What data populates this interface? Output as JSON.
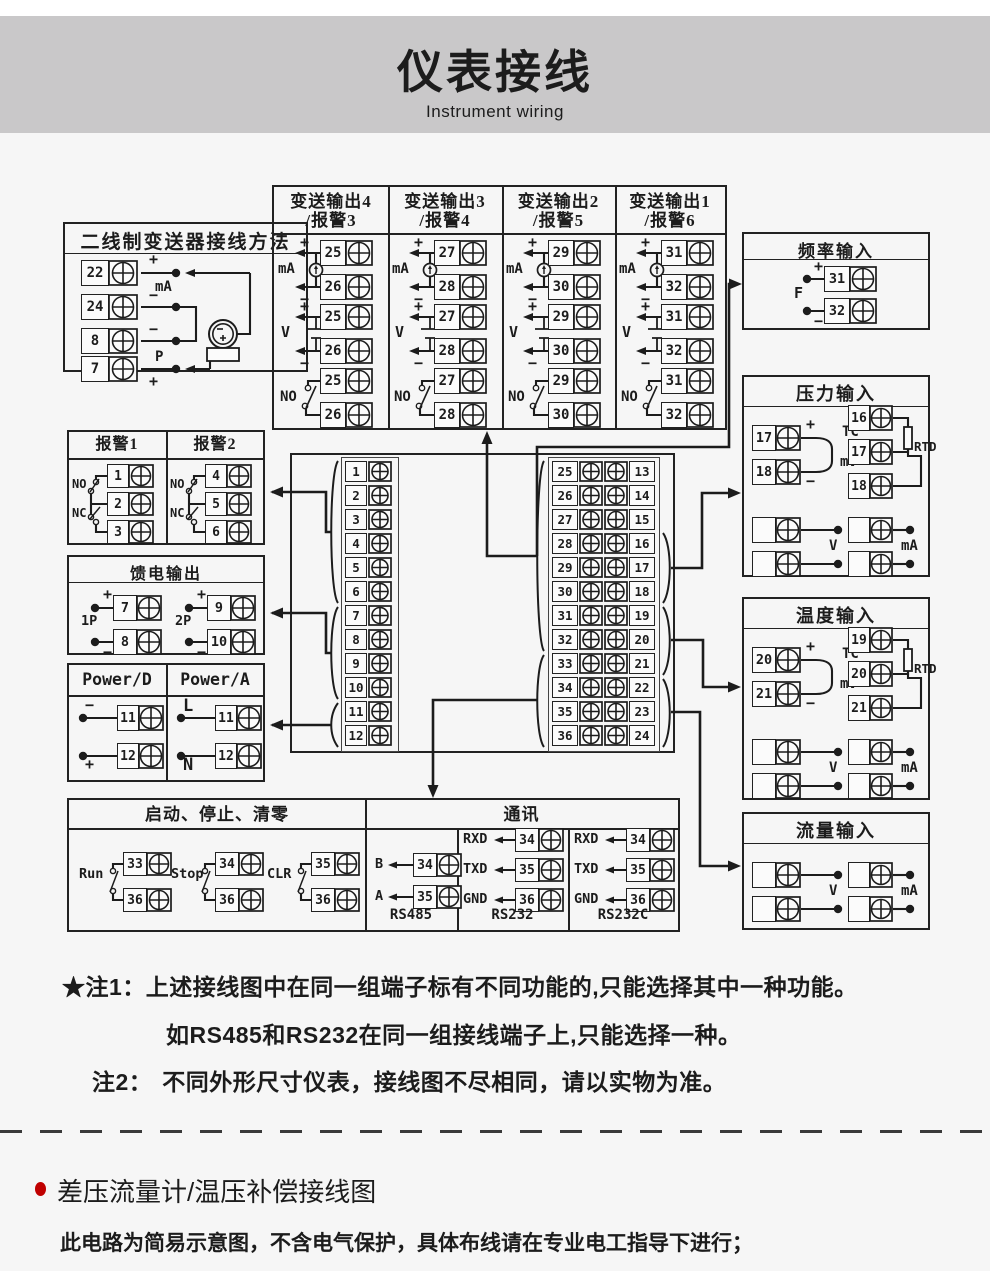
{
  "header": {
    "title": "仪表接线",
    "subtitle": "Instrument wiring"
  },
  "colors": {
    "line": "#1c1c1c",
    "header_bg": "#c9c8c9",
    "page_bg": "#f6f6f6",
    "bullet": "#c00000"
  },
  "boxes": {
    "two_wire": {
      "title": "二线制变送器接线方法",
      "rows": [
        {
          "no": "22",
          "sign": "+"
        },
        {
          "no": "24",
          "sign": "−"
        },
        {
          "no": "8",
          "sign": "−"
        },
        {
          "no": "7",
          "sign": "+"
        }
      ],
      "mid_labels": {
        "ma": "mA",
        "p": "P"
      },
      "transmitter": {
        "minus": "−",
        "plus": "+"
      }
    },
    "outputs": {
      "labels": {
        "ma": "mA",
        "v": "V",
        "no": "NO",
        "plus": "+",
        "minus": "−"
      },
      "columns": [
        {
          "title1": "变送输出4",
          "title2": "/报警3",
          "pairs": [
            [
              "25",
              "26"
            ],
            [
              "25",
              "26"
            ],
            [
              "25",
              "26"
            ]
          ]
        },
        {
          "title1": "变送输出3",
          "title2": "/报警4",
          "pairs": [
            [
              "27",
              "28"
            ],
            [
              "27",
              "28"
            ],
            [
              "27",
              "28"
            ]
          ]
        },
        {
          "title1": "变送输出2",
          "title2": "/报警5",
          "pairs": [
            [
              "29",
              "30"
            ],
            [
              "29",
              "30"
            ],
            [
              "29",
              "30"
            ]
          ]
        },
        {
          "title1": "变送输出1",
          "title2": "/报警6",
          "pairs": [
            [
              "31",
              "32"
            ],
            [
              "31",
              "32"
            ],
            [
              "31",
              "32"
            ]
          ]
        }
      ]
    },
    "freq": {
      "title": "频率输入",
      "label": "F",
      "rows": [
        {
          "no": "31",
          "sign": "+"
        },
        {
          "no": "32",
          "sign": "−"
        }
      ]
    },
    "alarm": {
      "columns": [
        {
          "title": "报警1",
          "nos": [
            "1",
            "2",
            "3"
          ]
        },
        {
          "title": "报警2",
          "nos": [
            "4",
            "5",
            "6"
          ]
        }
      ],
      "sw": {
        "no": "NO",
        "nc": "NC"
      }
    },
    "feed": {
      "title": "馈电输出",
      "groups": [
        {
          "label": "1P",
          "rows": [
            {
              "no": "7",
              "sign": "+"
            },
            {
              "no": "8",
              "sign": "−"
            }
          ]
        },
        {
          "label": "2P",
          "rows": [
            {
              "no": "9",
              "sign": "+"
            },
            {
              "no": "10",
              "sign": "−"
            }
          ]
        }
      ]
    },
    "power": {
      "columns": [
        {
          "title": "Power/D",
          "rows": [
            {
              "no": "11",
              "sign": "−"
            },
            {
              "no": "12",
              "sign": "+"
            }
          ]
        },
        {
          "title": "Power/A",
          "rows": [
            {
              "no": "11",
              "sign": "L"
            },
            {
              "no": "12",
              "sign": "N"
            }
          ]
        }
      ]
    },
    "center": {
      "left": [
        "1",
        "2",
        "3",
        "4",
        "5",
        "6",
        "7",
        "8",
        "9",
        "10",
        "11",
        "12"
      ],
      "inner": [
        "25",
        "26",
        "27",
        "28",
        "29",
        "30",
        "31",
        "32",
        "33",
        "34",
        "35",
        "36"
      ],
      "right": [
        "13",
        "14",
        "15",
        "16",
        "17",
        "18",
        "19",
        "20",
        "21",
        "22",
        "23",
        "24"
      ]
    },
    "pressure": {
      "title": "压力输入",
      "tc": {
        "rows": [
          {
            "no": "17",
            "sign": "+"
          },
          {
            "no": "18",
            "sign": "−"
          }
        ],
        "l1": "TC",
        "l2": "/",
        "l3": "mV"
      },
      "rtd": {
        "nos": [
          "16",
          "17",
          "18"
        ],
        "label": "RTD"
      },
      "volt": {
        "rows": [
          {
            "no": "17",
            "sign": "+"
          },
          {
            "no": "18",
            "sign": "−"
          }
        ],
        "label": "V"
      },
      "amp": {
        "rows": [
          {
            "no": "16",
            "sign": "+"
          },
          {
            "no": "18",
            "sign": "−"
          }
        ],
        "label": "mA"
      }
    },
    "temp": {
      "title": "温度输入",
      "tc": {
        "rows": [
          {
            "no": "20",
            "sign": "+"
          },
          {
            "no": "21",
            "sign": "−"
          }
        ],
        "l1": "TC",
        "l2": "/",
        "l3": "mV"
      },
      "rtd": {
        "nos": [
          "19",
          "20",
          "21"
        ],
        "label": "RTD"
      },
      "volt": {
        "rows": [
          {
            "no": "20",
            "sign": "+"
          },
          {
            "no": "21",
            "sign": "−"
          }
        ],
        "label": "V"
      },
      "amp": {
        "rows": [
          {
            "no": "19",
            "sign": "+"
          },
          {
            "no": "21",
            "sign": "−"
          }
        ],
        "label": "mA"
      }
    },
    "flow": {
      "title": "流量输入",
      "volt": {
        "rows": [
          {
            "no": "23",
            "sign": "+"
          },
          {
            "no": "24",
            "sign": "−"
          }
        ],
        "label": "V"
      },
      "amp": {
        "rows": [
          {
            "no": "22",
            "sign": "+"
          },
          {
            "no": "24",
            "sign": "−"
          }
        ],
        "label": "mA"
      }
    },
    "runstop": {
      "title": "启动、停止、清零",
      "switches": [
        {
          "label": "Run",
          "a": "33",
          "b": "36"
        },
        {
          "label": "Stop",
          "a": "34",
          "b": "36"
        },
        {
          "label": "CLR",
          "a": "35",
          "b": "36"
        }
      ]
    },
    "comm": {
      "title": "通讯",
      "sections": [
        {
          "name": "RS485",
          "rows": [
            {
              "label": "B",
              "no": "34"
            },
            {
              "label": "A",
              "no": "35"
            }
          ]
        },
        {
          "name": "RS232",
          "rows": [
            {
              "label": "RXD",
              "no": "34"
            },
            {
              "label": "TXD",
              "no": "35"
            },
            {
              "label": "GND",
              "no": "36"
            }
          ]
        },
        {
          "name": "RS232C",
          "rows": [
            {
              "label": "RXD",
              "no": "34"
            },
            {
              "label": "TXD",
              "no": "35"
            },
            {
              "label": "GND",
              "no": "36"
            }
          ]
        }
      ]
    }
  },
  "notes": {
    "n1_label": "★注1：",
    "n1_text": "上述接线图中在同一组端子标有不同功能的,只能选择其中一种功能。",
    "n1_text2": "如RS485和RS232在同一组接线端子上,只能选择一种。",
    "n2_label": "注2：",
    "n2_text": "不同外形尺寸仪表，接线图不尽相同，请以实物为准。"
  },
  "bottom": {
    "heading": "差压流量计/温压补偿接线图",
    "body": "此电路为简易示意图，不含电气保护，具体布线请在专业电工指导下进行；"
  }
}
